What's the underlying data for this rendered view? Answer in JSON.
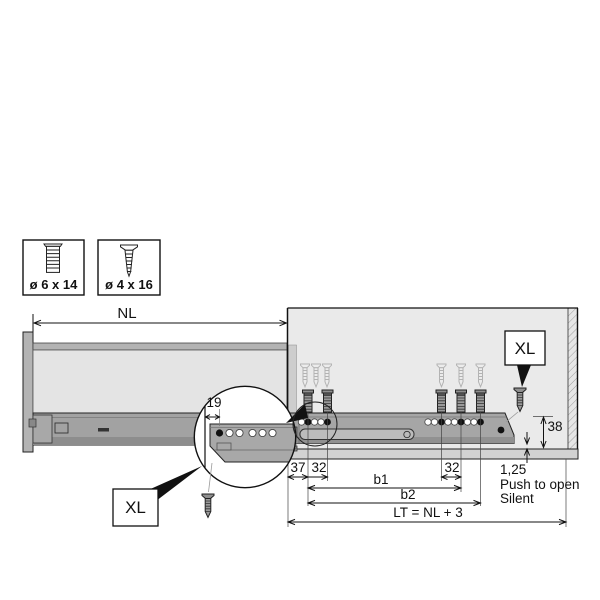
{
  "legend": {
    "screws": [
      {
        "size": "ø 6 x 14",
        "icon": "euro-screw-icon"
      },
      {
        "size": "ø 4 x 16",
        "icon": "countersunk-screw-icon"
      }
    ]
  },
  "dimensions": {
    "nominal_length": "NL",
    "back_offset": "19",
    "front_setback": "37",
    "hole_pitch_front": "32",
    "hole_pitch_rear": "32",
    "b1": "b1",
    "b2": "b2",
    "total_length_formula": "LT = NL + 3",
    "rail_height": "38",
    "bottom_gap": "1,25"
  },
  "callouts": {
    "xl_drawer": "XL",
    "xl_cabinet": "XL"
  },
  "notes": {
    "push_to_open": "Push to open",
    "silent": "Silent"
  },
  "colors": {
    "background": "#ffffff",
    "line": "#111111",
    "cabinet_panel": "#eaeaea",
    "drawer_panel": "#e4e4e4",
    "rail_gray": "#a6a6a6",
    "shelf_gray": "#d2d2d2",
    "screw_ghost": "#b3b3b3",
    "screw_dark": "#8f8f8f"
  }
}
